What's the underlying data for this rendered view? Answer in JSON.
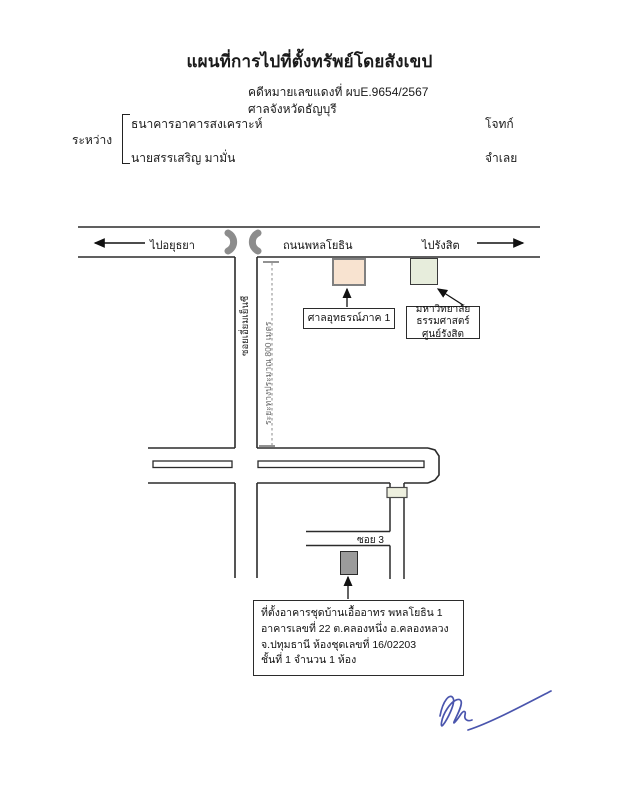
{
  "header": {
    "title": "แผนที่การไปที่ตั้งทรัพย์โดยสังเขป",
    "case_number_line": "คดีหมายเลขแดงที่ ผบE.9654/2567",
    "court_line": "ศาลจังหวัดธัญบุรี"
  },
  "parties": {
    "between_label": "ระหว่าง",
    "plaintiff": {
      "name": "ธนาคารอาคารสงเคราะห์",
      "role": "โจทก์"
    },
    "defendant": {
      "name": "นายสรรเสริญ มามั่น",
      "role": "จำเลย"
    }
  },
  "map": {
    "road_name": "ถนนพหลโยธิน",
    "directions": {
      "west": "ไปอยุธยา",
      "east": "ไปรังสิต"
    },
    "side_road_name": "ซอยเอี่ยมเย็นชี",
    "distance_note": "ระยะทางประมาณ 800 เมตร",
    "soi3_label": "ซอย 3",
    "landmarks": [
      {
        "label": "ศาลอุทธรณ์ภาค 1",
        "color": "#f8e3d0"
      },
      {
        "line1": "มหาวิทยาลัยธรรมศาสตร์",
        "line2": "ศูนย์รังสิต",
        "color": "#e7eddc"
      }
    ],
    "property_note": {
      "line1": "ที่ตั้งอาคารชุดบ้านเอื้ออาทร พหลโยธิน 1",
      "line2": "อาคารเลขที่ 22 ต.คลองหนึ่ง อ.คลองหลวง",
      "line3": "จ.ปทุมธานี ห้องชุดเลขที่ 16/02203",
      "line4": "ชั้นที่ 1 จำนวน 1 ห้อง"
    },
    "colors": {
      "road_line": "#2b2b2b",
      "uturn_symbol": "#8c8c8c",
      "property_building": "#9b9b9b",
      "signature_ink": "#4a55ad"
    }
  }
}
